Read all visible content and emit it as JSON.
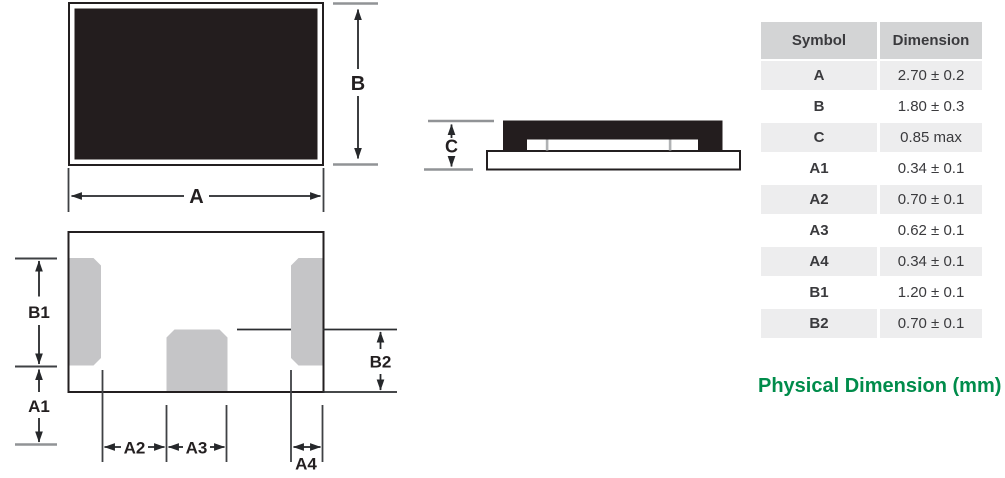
{
  "diagram": {
    "top_view": {
      "labels": {
        "a": "A",
        "b": "B"
      }
    },
    "side_view": {
      "labels": {
        "c": "C"
      }
    },
    "land_pattern_view": {
      "labels": {
        "b1": "B1",
        "a1": "A1",
        "a2": "A2",
        "a3": "A3",
        "a4": "A4",
        "b2": "B2"
      }
    }
  },
  "table": {
    "headers": {
      "symbol": "Symbol",
      "dimension": "Dimension"
    },
    "rows": [
      {
        "symbol": "A",
        "dimension": "2.70 ± 0.2"
      },
      {
        "symbol": "B",
        "dimension": "1.80 ± 0.3"
      },
      {
        "symbol": "C",
        "dimension": "0.85 max"
      },
      {
        "symbol": "A1",
        "dimension": "0.34 ± 0.1"
      },
      {
        "symbol": "A2",
        "dimension": "0.70 ± 0.1"
      },
      {
        "symbol": "A3",
        "dimension": "0.62 ± 0.1"
      },
      {
        "symbol": "A4",
        "dimension": "0.34 ± 0.1"
      },
      {
        "symbol": "B1",
        "dimension": "1.20 ± 0.1"
      },
      {
        "symbol": "B2",
        "dimension": "0.70 ± 0.1"
      }
    ]
  },
  "caption": "Physical Dimension (mm)",
  "colors": {
    "accent_green": "#008c4b",
    "body_black": "#231d1e",
    "pad_gray": "#c5c5c7",
    "table_header_bg": "#d3d4d5",
    "table_row_alt_bg": "#ededee"
  }
}
